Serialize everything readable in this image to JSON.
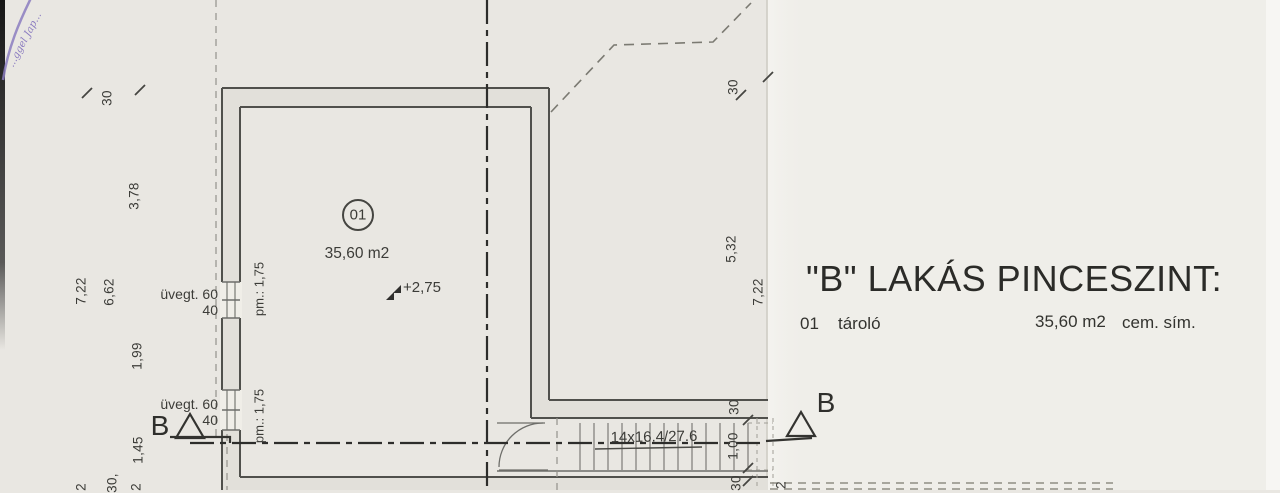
{
  "colors": {
    "paper": "#e9e7e2",
    "paper_right_panel": "#efeee9",
    "ink": "#3c3c38",
    "wall_line": "#50504c",
    "stamp_purple": "#8b7cc0",
    "scan_edge_black": "#1a1a1a"
  },
  "plan": {
    "room": {
      "number": "01",
      "area": "35,60 m2",
      "level": "+2,75"
    },
    "stair_label": "14x16.4/27.6",
    "section_marker_left": "B",
    "section_marker_right": "B",
    "windows": [
      {
        "type": "üvegt. 60",
        "size": "40",
        "parapet": "pm.: 1,75"
      },
      {
        "type": "üvegt. 60",
        "size": "40",
        "parapet": "pm.: 1,75"
      }
    ],
    "dims_left": [
      "30",
      "3,78",
      "7,22",
      "6,62",
      "1,99",
      "1,45"
    ],
    "dims_left_bottom": [
      "2",
      "30,",
      "2"
    ],
    "dims_right": [
      "30",
      "5,32",
      "7,22",
      "30",
      "1,00",
      "30",
      "2"
    ],
    "stamp_text": "...ggel Jap..."
  },
  "legend": {
    "title": "\"B\" LAKÁS PINCESZINT:",
    "entries": [
      {
        "no": "01",
        "name": "tároló",
        "area": "35,60 m2",
        "finish": "cem. sím."
      }
    ]
  }
}
